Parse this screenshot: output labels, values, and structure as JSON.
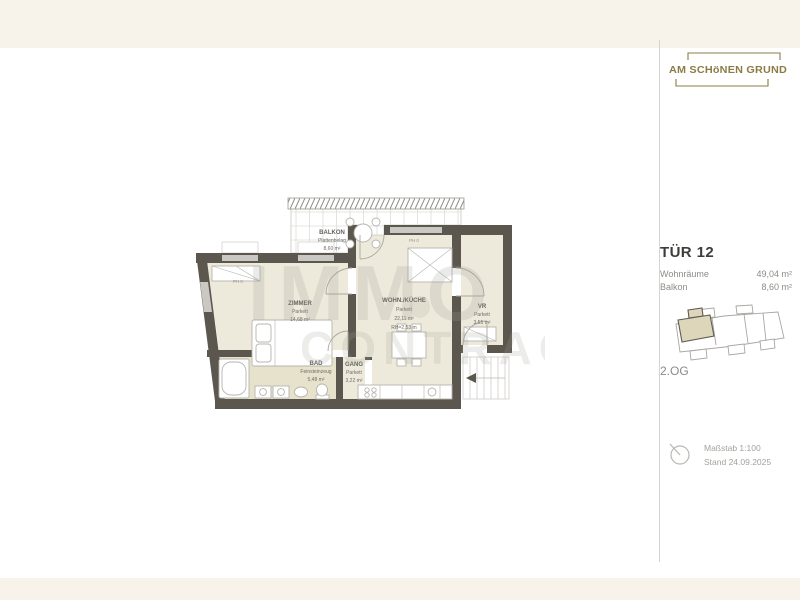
{
  "branding": {
    "logo_text": "AM SCHöNEN GRUND"
  },
  "sidebar": {
    "unit": {
      "title": "TÜR 12",
      "rows": [
        {
          "label": "Wohnräume",
          "value": "49,04 m²"
        },
        {
          "label": "Balkon",
          "value": "8,60 m²"
        }
      ]
    },
    "floor_label": "2.OG",
    "scale_line": "Maßstab 1:100",
    "date_line": "Stand 24.09.2025"
  },
  "floorplan": {
    "watermark": {
      "line1": "IMMO",
      "line2": "CONTRACT"
    },
    "rooms": {
      "balkon": {
        "name": "BALKON",
        "finish": "Plattenbelag",
        "area": "8,60 m²"
      },
      "zimmer": {
        "name": "ZIMMER",
        "finish": "Parkett",
        "area": "14,68 m²"
      },
      "wohn_kueche": {
        "name": "WOHN./KÜCHE",
        "finish": "Parkett",
        "area": "22,11 m²",
        "height": "RH=2,53 m"
      },
      "bad": {
        "name": "BAD",
        "finish": "Feinsteinzeug",
        "area": "5,48 m²"
      },
      "gang": {
        "name": "GANG",
        "finish": "Parkett",
        "area": "3,22 m²"
      },
      "vr": {
        "name": "VR",
        "finish": "Parkett",
        "area": "3,55 m²"
      }
    },
    "annotations": {
      "ph1": "PH 0",
      "ph2": "PH 0"
    }
  },
  "colors": {
    "accent_gold": "#8b7c46",
    "wall": "#5b574e",
    "room_fill": "#eeeadb",
    "bath_fill": "#e6e2cc",
    "highlight_unit": "#ddd6ba",
    "background_cream": "#f7f3eb"
  }
}
